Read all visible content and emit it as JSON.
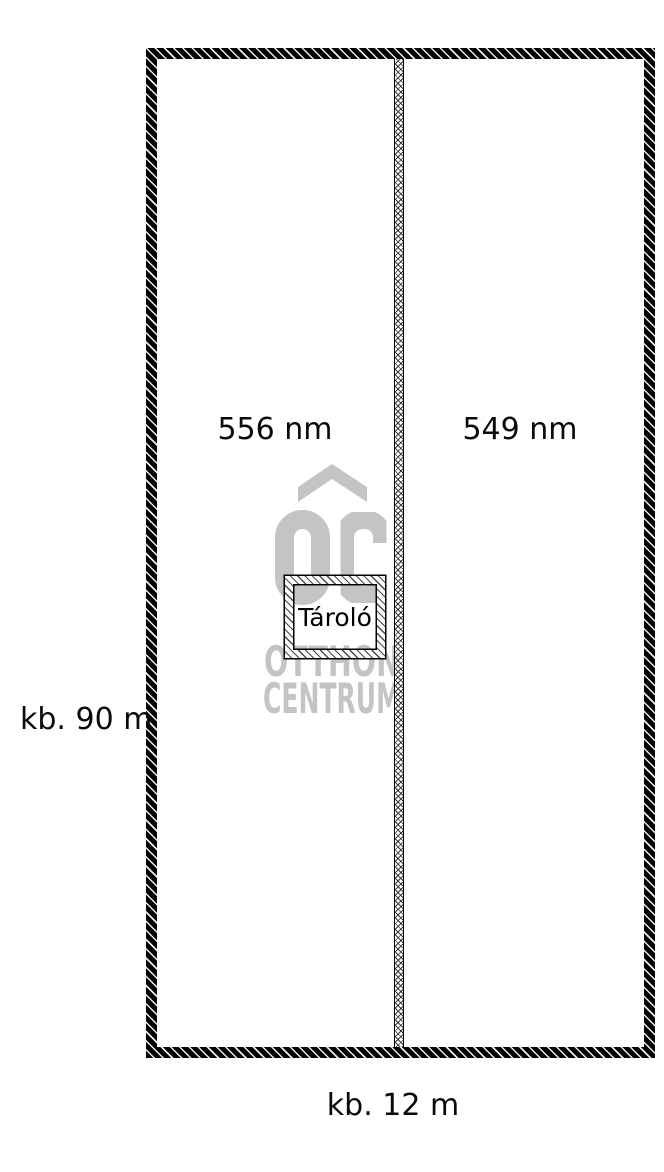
{
  "plan": {
    "type": "site-plan",
    "parcels": [
      {
        "area_label": "556 nm"
      },
      {
        "area_label": "549 nm"
      }
    ],
    "storage_label": "Tároló",
    "dimensions": {
      "height_label": "kb. 90 m",
      "width_label": "kb. 12 m"
    },
    "watermark": {
      "brand_line1": "OTTHON",
      "brand_line2": "CENTRUM",
      "icon": "roof-chevron-and-oc-monogram"
    },
    "colors": {
      "line": "#000000",
      "watermark_gray": "#c4c4c4",
      "background": "#ffffff"
    }
  }
}
